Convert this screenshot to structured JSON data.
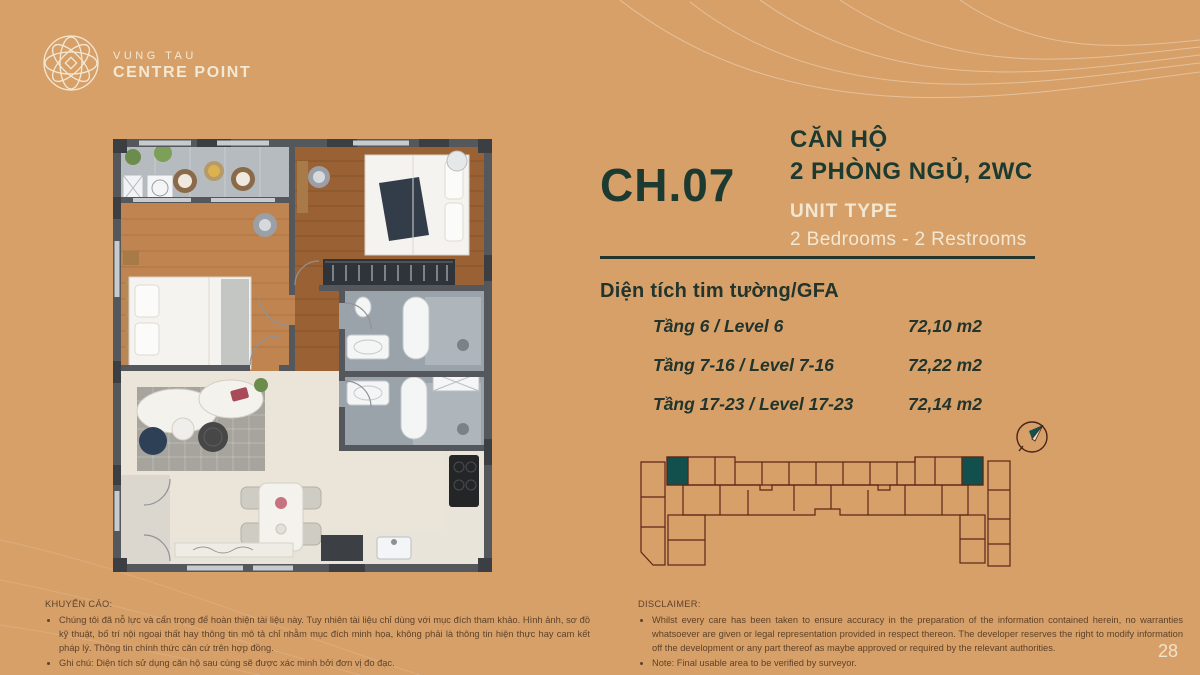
{
  "page": {
    "number": "28",
    "background_color": "#d7a069"
  },
  "logo": {
    "line1": "VUNG TAU",
    "line2": "CENTRE POINT",
    "color": "#f3e8d3"
  },
  "unit": {
    "code": "CH.07",
    "title_vi_line1": "CĂN HỘ",
    "title_vi_line2": "2 PHÒNG NGỦ, 2WC",
    "unit_type_label": "UNIT TYPE",
    "unit_type_value": "2 Bedrooms - 2 Restrooms",
    "accent_color": "#1d3a31"
  },
  "area_table": {
    "heading": "Diện tích tim tường/GFA",
    "rows": [
      {
        "label": "Tầng 6 / Level 6",
        "value": "72,10 m2"
      },
      {
        "label": "Tầng 7-16 / Level 7-16",
        "value": "72,22 m2"
      },
      {
        "label": "Tầng 17-23 / Level 17-23",
        "value": "72,14 m2"
      }
    ]
  },
  "keyplan": {
    "highlighted_unit": "CH.07",
    "highlight_color": "#11504d",
    "outline_color": "#5b2517",
    "compass": "north-east"
  },
  "advisory_vi": {
    "heading": "KHUYẾN CÁO:",
    "bullets": [
      "Chúng tôi đã nỗ lực và cẩn trọng để hoàn thiện tài liệu này. Tuy nhiên tài liệu chỉ dùng với mục đích tham khảo. Hình ảnh, sơ đồ kỹ thuật, bố trí nội ngoại thất hay thông tin mô tả chỉ nhằm mục đích minh họa, không phải là thông tin hiện thực hay cam kết pháp lý. Thông tin chính thức căn cứ trên hợp đồng.",
      "Ghi chú: Diện tích sử dụng căn hộ sau cùng sẽ được xác minh bởi đơn vị đo đạc."
    ]
  },
  "disclaimer_en": {
    "heading": "DISCLAIMER:",
    "bullets": [
      "Whilst every care has been taken to ensure accuracy in the preparation of the information contained herein, no warranties whatsoever are given or legal representation provided in respect thereon. The developer reserves the right to modify information off the development or any part thereof as maybe approved or required by the relevant authorities.",
      "Note: Final usable area to be verified by surveyor."
    ]
  },
  "floor_plan_colors": {
    "wall": "#54575b",
    "wood_light": "#c08451",
    "wood_dark": "#9a6134",
    "tile_cream": "#eae4d9",
    "bathroom_gray": "#9ba3aa",
    "balcony_gray": "#b6bbc0"
  }
}
